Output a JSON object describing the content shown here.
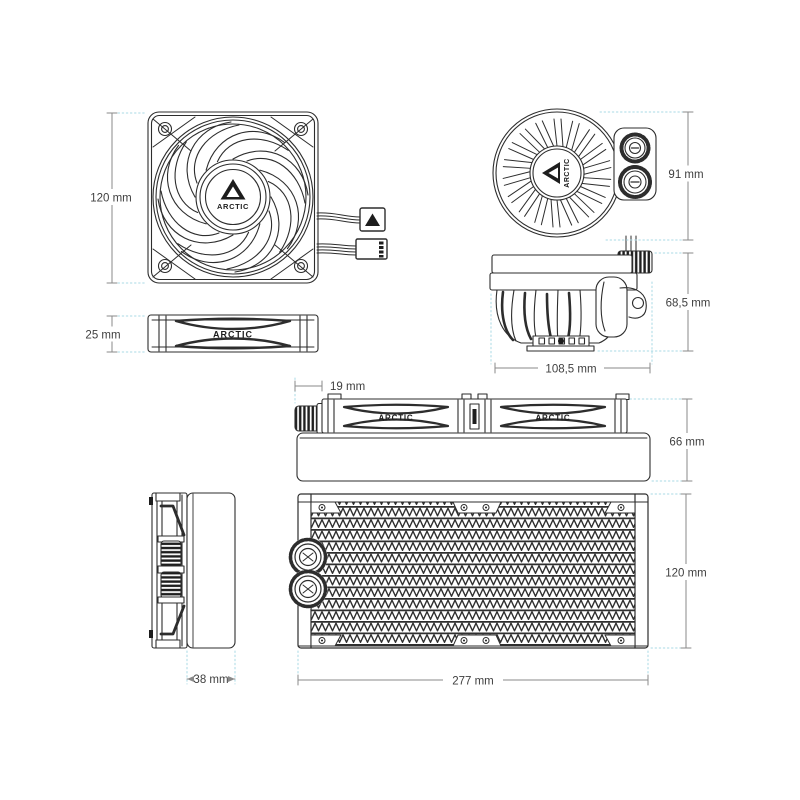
{
  "diagram": {
    "brand": "ARCTIC",
    "colors": {
      "line": "#2d2d2d",
      "dimension_line": "#8a8a8a",
      "extension_line": "#a9dae5",
      "label_text": "#3f3f3f",
      "background": "#ffffff"
    },
    "views": {
      "fan_front": {
        "height_label": "120 mm"
      },
      "fan_side": {
        "thickness_label": "25 mm"
      },
      "pump_top": {
        "width_label": "91 mm"
      },
      "pump_side": {
        "height_label": "68,5 mm",
        "width_label": "108,5 mm"
      },
      "radiator_assembly_side": {
        "fitting_label": "19 mm",
        "height_label": "66 mm"
      },
      "radiator_end": {
        "depth_label": "38 mm"
      },
      "radiator_front": {
        "height_label": "120 mm",
        "length_label": "277 mm"
      }
    }
  }
}
